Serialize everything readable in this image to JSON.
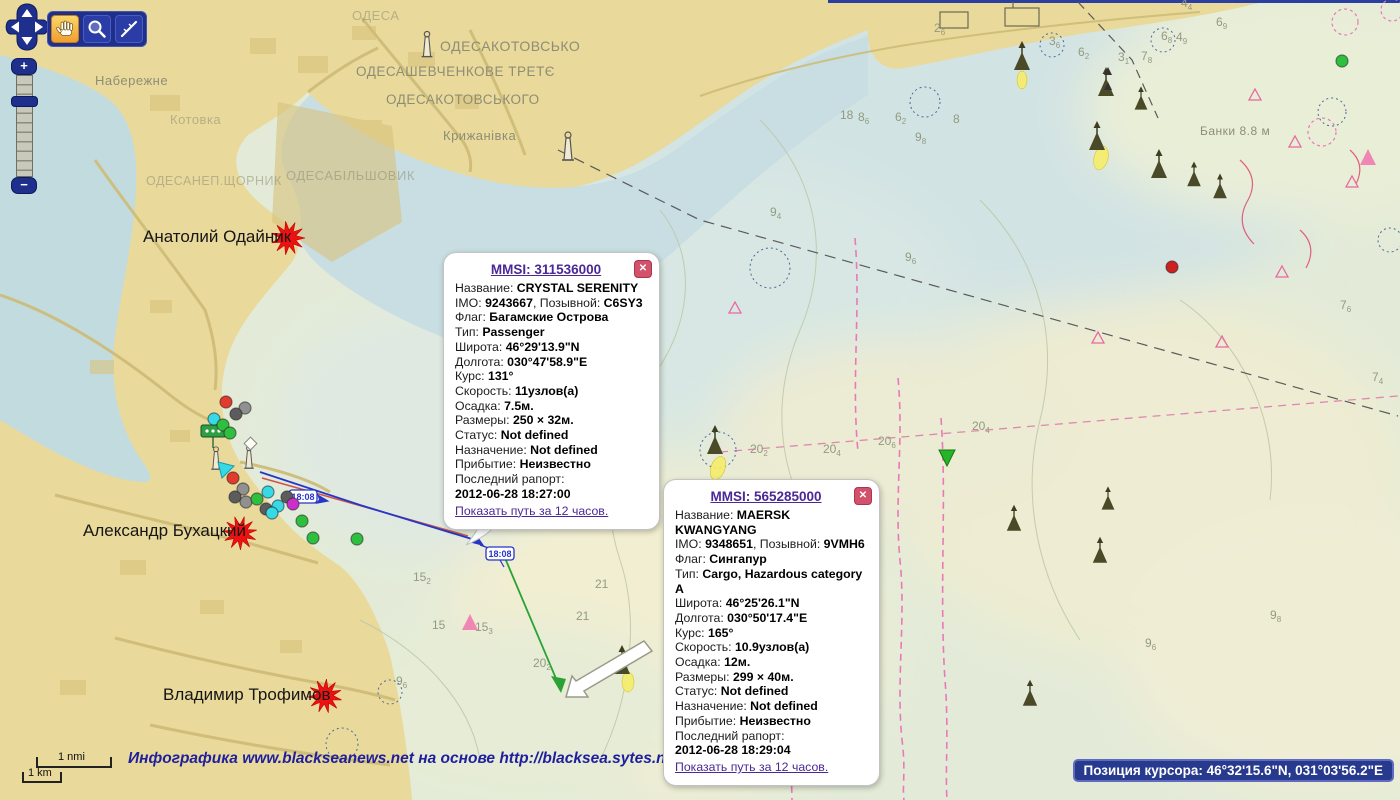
{
  "map": {
    "attribution": "Инфографика www.blackseanews.net на основе http://blacksea.sytes.net",
    "cursor_position": "Позиция курсора: 46°32'15.6\"N, 031°03'56.2\"E",
    "scale": {
      "nmi": "1 nmi",
      "km": "1 km"
    },
    "track_time_labels": [
      "18:08",
      "18:08"
    ],
    "place_labels": [
      {
        "text": "ОДЕСА",
        "x": 352,
        "y": 8,
        "size": 13,
        "faded": true
      },
      {
        "text": "ОДЕСАКОТОВСЬКО",
        "x": 440,
        "y": 38,
        "size": 14,
        "faded": false
      },
      {
        "text": "ОДЕСАШЕВЧЕНКОВЕ ТРЕТЄ",
        "x": 356,
        "y": 64,
        "size": 13.5,
        "faded": false
      },
      {
        "text": "ОДЕСАКОТОВСЬКОГО",
        "x": 386,
        "y": 92,
        "size": 13.5,
        "faded": false
      },
      {
        "text": "Набережне",
        "x": 95,
        "y": 73,
        "size": 13,
        "faded": false
      },
      {
        "text": "Котовка",
        "x": 170,
        "y": 112,
        "size": 13,
        "faded": true
      },
      {
        "text": "Крижанівка",
        "x": 443,
        "y": 128,
        "size": 13,
        "faded": false
      },
      {
        "text": "ОДЕСАБІЛЬШОВИК",
        "x": 286,
        "y": 168,
        "size": 13,
        "faded": true
      },
      {
        "text": "ОДЕСАНЕП.ЩОРНИК",
        "x": 146,
        "y": 174,
        "size": 12.5,
        "faded": true
      },
      {
        "text": "Банки 8.8 м",
        "x": 1200,
        "y": 124,
        "size": 12,
        "faded": false
      }
    ],
    "journalist_markers": [
      {
        "name": "Анатолий Одайник",
        "label_x": 143,
        "label_y": 227,
        "star_x": 288,
        "star_y": 238
      },
      {
        "name": "Александр Бухацкий",
        "label_x": 83,
        "label_y": 521,
        "star_x": 240,
        "star_y": 533
      },
      {
        "name": "Владимир Трофимов",
        "label_x": 163,
        "label_y": 685,
        "star_x": 325,
        "star_y": 696
      }
    ],
    "soundings": [
      [
        840,
        119,
        "18",
        ""
      ],
      [
        858,
        121,
        "8",
        "6"
      ],
      [
        895,
        121,
        "6",
        "2"
      ],
      [
        915,
        141,
        "9",
        "8"
      ],
      [
        953,
        123,
        "8",
        ""
      ],
      [
        934,
        32,
        "2",
        "6"
      ],
      [
        1049,
        45,
        "3",
        "6"
      ],
      [
        1078,
        56,
        "6",
        "2"
      ],
      [
        1118,
        61,
        "3",
        "1"
      ],
      [
        1141,
        60,
        "7",
        "8"
      ],
      [
        1161,
        40,
        "6",
        "8"
      ],
      [
        1176,
        41,
        "4",
        "9"
      ],
      [
        1181,
        7,
        "4",
        "4"
      ],
      [
        1216,
        26,
        "6",
        "9"
      ],
      [
        770,
        216,
        "9",
        "4"
      ],
      [
        905,
        261,
        "9",
        "6"
      ],
      [
        413,
        581,
        "15",
        "2"
      ],
      [
        432,
        629,
        "15",
        ""
      ],
      [
        475,
        631,
        "15",
        "3"
      ],
      [
        396,
        685,
        "9",
        "6"
      ],
      [
        533,
        667,
        "20",
        "2"
      ],
      [
        572,
        520,
        "20",
        "2"
      ],
      [
        595,
        588,
        "21",
        ""
      ],
      [
        576,
        620,
        "21",
        ""
      ],
      [
        750,
        453,
        "20",
        "2"
      ],
      [
        823,
        453,
        "20",
        "4"
      ],
      [
        878,
        445,
        "20",
        "6"
      ],
      [
        972,
        430,
        "20",
        "4"
      ],
      [
        1145,
        647,
        "9",
        "6"
      ],
      [
        1372,
        381,
        "7",
        "4"
      ],
      [
        1340,
        309,
        "7",
        "6"
      ],
      [
        1270,
        619,
        "9",
        "8"
      ]
    ],
    "dot_colors": {
      "red": "#e23b2e",
      "gray": "#909090",
      "dk": "#5c5c5c",
      "cyan": "#36d9e6",
      "grn": "#2fbf3f",
      "mag": "#cc2ecc",
      "redp": "#cf2020"
    },
    "vessel_dots": [
      [
        226,
        402,
        "red"
      ],
      [
        245,
        408,
        "gray"
      ],
      [
        236,
        414,
        "dk"
      ],
      [
        214,
        419,
        "cyan"
      ],
      [
        223,
        425,
        "grn"
      ],
      [
        230,
        433,
        "grn"
      ],
      [
        233,
        478,
        "red"
      ],
      [
        243,
        489,
        "gray"
      ],
      [
        235,
        497,
        "dk"
      ],
      [
        246,
        502,
        "gray"
      ],
      [
        257,
        499,
        "grn"
      ],
      [
        268,
        492,
        "cyan"
      ],
      [
        266,
        509,
        "dk"
      ],
      [
        278,
        506,
        "cyan"
      ],
      [
        287,
        497,
        "dk"
      ],
      [
        293,
        504,
        "mag"
      ],
      [
        272,
        513,
        "cyan"
      ],
      [
        302,
        521,
        "grn"
      ],
      [
        313,
        538,
        "grn"
      ],
      [
        357,
        539,
        "grn"
      ],
      [
        1342,
        61,
        "grn"
      ],
      [
        1172,
        267,
        "redp"
      ]
    ]
  },
  "controls": {
    "zoom_in": "+",
    "zoom_out": "−",
    "buttons": [
      {
        "label": "pan-tool",
        "icon": "hand-icon",
        "active": true
      },
      {
        "label": "zoom-tool",
        "icon": "magnifier-icon",
        "active": false
      },
      {
        "label": "measure-tool",
        "icon": "ruler-icon",
        "active": false
      }
    ]
  },
  "popups": [
    {
      "mmsi_label": "MMSI: 311536000",
      "close": "✕",
      "lines": [
        [
          [
            "l",
            "Название: "
          ],
          [
            "v",
            "CRYSTAL SERENITY"
          ]
        ],
        [
          [
            "l",
            "IMO: "
          ],
          [
            "v",
            "9243667"
          ],
          [
            "l",
            ", Позывной: "
          ],
          [
            "v",
            "C6SY3"
          ]
        ],
        [
          [
            "l",
            "Флаг: "
          ],
          [
            "v",
            "Багамские Острова"
          ]
        ],
        [
          [
            "l",
            "Тип: "
          ],
          [
            "v",
            "Passenger"
          ]
        ],
        [
          [
            "l",
            "Широта: "
          ],
          [
            "v",
            "46°29'13.9\"N"
          ]
        ],
        [
          [
            "l",
            "Долгота: "
          ],
          [
            "v",
            "030°47'58.9\"E"
          ]
        ],
        [
          [
            "l",
            "Курс: "
          ],
          [
            "v",
            "131°"
          ]
        ],
        [
          [
            "l",
            "Скорость: "
          ],
          [
            "v",
            "11узлов(а)"
          ]
        ],
        [
          [
            "l",
            "Осадка: "
          ],
          [
            "v",
            "7.5м."
          ]
        ],
        [
          [
            "l",
            "Размеры: "
          ],
          [
            "v",
            "250 × 32м."
          ]
        ],
        [
          [
            "l",
            "Статус: "
          ],
          [
            "v",
            "Not defined"
          ]
        ],
        [
          [
            "l",
            "Назначение: "
          ],
          [
            "v",
            "Not defined"
          ]
        ],
        [
          [
            "l",
            "Прибытие: "
          ],
          [
            "v",
            "Неизвестно"
          ]
        ],
        [
          [
            "l",
            "Последний рапорт:"
          ]
        ],
        [
          [
            "v",
            "2012-06-28 18:27:00"
          ]
        ]
      ],
      "path_link": "Показать путь за 12 часов."
    },
    {
      "mmsi_label": "MMSI: 565285000",
      "close": "✕",
      "lines": [
        [
          [
            "l",
            "Название: "
          ],
          [
            "v",
            "MAERSK KWANGYANG"
          ]
        ],
        [
          [
            "l",
            "IMO: "
          ],
          [
            "v",
            "9348651"
          ],
          [
            "l",
            ", Позывной: "
          ],
          [
            "v",
            "9VMH6"
          ]
        ],
        [
          [
            "l",
            "Флаг: "
          ],
          [
            "v",
            "Сингапур"
          ]
        ],
        [
          [
            "l",
            "Тип: "
          ],
          [
            "v",
            "Cargo, Hazardous category A"
          ]
        ],
        [
          [
            "l",
            "Широта: "
          ],
          [
            "v",
            "46°25'26.1\"N"
          ]
        ],
        [
          [
            "l",
            "Долгота: "
          ],
          [
            "v",
            "030°50'17.4\"E"
          ]
        ],
        [
          [
            "l",
            "Курс: "
          ],
          [
            "v",
            "165°"
          ]
        ],
        [
          [
            "l",
            "Скорость: "
          ],
          [
            "v",
            "10.9узлов(а)"
          ]
        ],
        [
          [
            "l",
            "Осадка: "
          ],
          [
            "v",
            "12м."
          ]
        ],
        [
          [
            "l",
            "Размеры: "
          ],
          [
            "v",
            "299 × 40м."
          ]
        ],
        [
          [
            "l",
            "Статус: "
          ],
          [
            "v",
            "Not defined"
          ]
        ],
        [
          [
            "l",
            "Назначение: "
          ],
          [
            "v",
            "Not defined"
          ]
        ],
        [
          [
            "l",
            "Прибытие: "
          ],
          [
            "v",
            "Неизвестно"
          ]
        ],
        [
          [
            "l",
            "Последний рапорт:"
          ]
        ],
        [
          [
            "v",
            "2012-06-28 18:29:04"
          ]
        ]
      ],
      "path_link": "Показать путь за 12 часов."
    }
  ]
}
